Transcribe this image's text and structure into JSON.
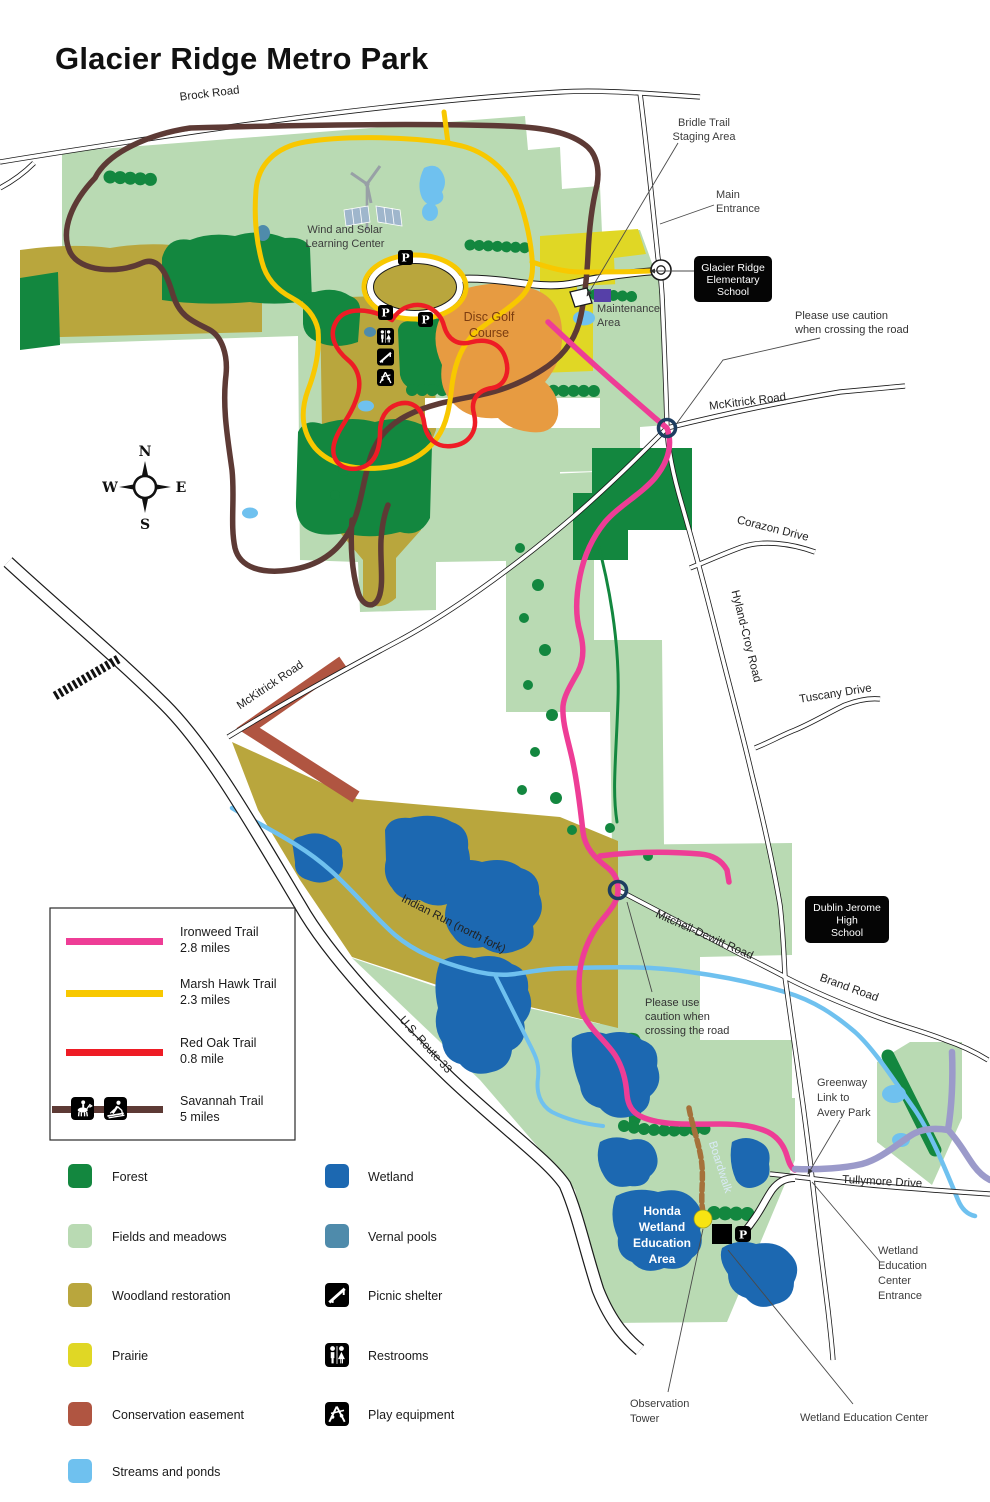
{
  "title": "Glacier Ridge Metro Park",
  "colors": {
    "ironweed": "#ee3d96",
    "marsh_hawk": "#f8c800",
    "red_oak": "#ee1c25",
    "savannah": "#5d3a35",
    "forest": "#13873f",
    "fields": "#b9dab3",
    "woodland": "#b9a63d",
    "prairie": "#e0d725",
    "conservation": "#b05541",
    "streams": "#6fc1ef",
    "wetland": "#1c68b1",
    "vernal": "#4f8bab",
    "greenway": "#9b9aca",
    "disc_golf": "#e79b41",
    "boardwalk": "#a5713a"
  },
  "roads": {
    "brock": "Brock Road",
    "mckitrick_east": "McKitrick Road",
    "mckitrick_west": "McKitrick Road",
    "corazon": "Corazon Drive",
    "hyland_croy": "Hyland-Croy Road",
    "tuscany": "Tuscany Drive",
    "mitchell_dewitt": "Mitchell-Dewitt Road",
    "brand": "Brand Road",
    "tullymore": "Tullymore Drive",
    "route_33": "U.S. Route 33"
  },
  "water": {
    "indian_run": "Indian Run (north fork)"
  },
  "poi": {
    "wind_solar": [
      "Wind and Solar",
      "Learning Center"
    ],
    "disc_golf": [
      "Disc Golf",
      "Course"
    ],
    "maintenance": [
      "Maintenance",
      "Area"
    ],
    "bridle": [
      "Bridle Trail",
      "Staging Area"
    ],
    "main_entrance": [
      "Main",
      "Entrance"
    ],
    "honda": [
      "Honda",
      "Wetland",
      "Education",
      "Area"
    ],
    "boardwalk": "Boardwalk",
    "observation": [
      "Observation",
      "Tower"
    ],
    "wec": "Wetland Education Center",
    "wec_entrance": [
      "Wetland",
      "Education",
      "Center",
      "Entrance"
    ],
    "greenway": [
      "Greenway",
      "Link to",
      "Avery Park"
    ],
    "caution_upper": [
      "Please use caution",
      "when crossing the road"
    ],
    "caution_lower": [
      "Please use",
      "caution when",
      "crossing the road"
    ]
  },
  "schools": {
    "elementary": [
      "Glacier Ridge",
      "Elementary",
      "School"
    ],
    "high": [
      "Dublin Jerome",
      "High",
      "School"
    ]
  },
  "compass": {
    "n": "N",
    "e": "E",
    "s": "S",
    "w": "W"
  },
  "parking_label": "P",
  "legend": {
    "trails": [
      {
        "name": "Ironweed Trail",
        "length": "2.8 miles",
        "color": "#ee3d96"
      },
      {
        "name": "Marsh Hawk Trail",
        "length": "2.3 miles",
        "color": "#f8c800"
      },
      {
        "name": "Red Oak Trail",
        "length": "0.8 mile",
        "color": "#ee1c25"
      },
      {
        "name": "Savannah Trail",
        "length": "5 miles",
        "color": "#5d3a35",
        "icons": [
          "horseback-icon",
          "ski-icon"
        ]
      }
    ],
    "areas": [
      {
        "label": "Forest",
        "color": "#13873f"
      },
      {
        "label": "Fields and meadows",
        "color": "#b9dab3"
      },
      {
        "label": "Woodland restoration",
        "color": "#b9a63d"
      },
      {
        "label": "Prairie",
        "color": "#e0d725"
      },
      {
        "label": "Conservation easement",
        "color": "#b05541"
      },
      {
        "label": "Streams and ponds",
        "color": "#6fc1ef"
      }
    ],
    "water_areas": [
      {
        "label": "Wetland",
        "color": "#1c68b1"
      },
      {
        "label": "Vernal pools",
        "color": "#4f8bab"
      }
    ],
    "facilities": [
      {
        "label": "Picnic shelter",
        "icon": "picnic-shelter-icon"
      },
      {
        "label": "Restrooms",
        "icon": "restrooms-icon"
      },
      {
        "label": "Play equipment",
        "icon": "play-equipment-icon"
      }
    ]
  }
}
